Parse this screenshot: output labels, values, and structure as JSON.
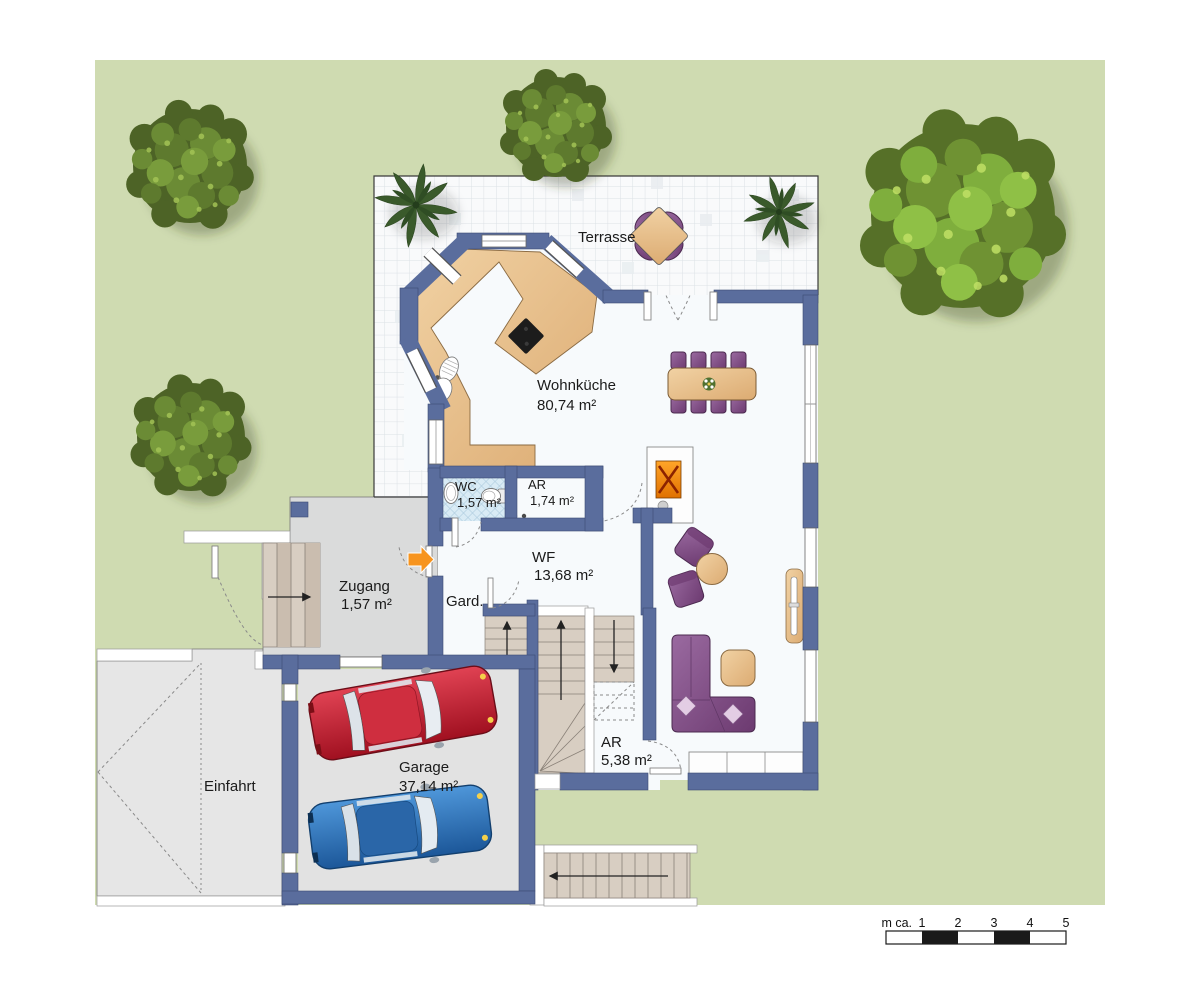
{
  "rooms": {
    "terrasse": {
      "label": "Terrasse"
    },
    "wohnkueche": {
      "label": "Wohnküche",
      "area": "80,74 m²"
    },
    "wc": {
      "label": "WC",
      "area": "1,57 m²"
    },
    "ar_eg": {
      "label": "AR",
      "area": "1,74 m²"
    },
    "wf": {
      "label": "WF",
      "area": "13,68 m²"
    },
    "zugang": {
      "label": "Zugang",
      "area": "1,57 m²"
    },
    "gard": {
      "label": "Gard."
    },
    "garage": {
      "label": "Garage",
      "area": "37,14 m²"
    },
    "ar_ug": {
      "label": "AR",
      "area": "5,38 m²"
    },
    "einfahrt": {
      "label": "Einfahrt"
    }
  },
  "scale_bar": {
    "unit_label": "m ca.",
    "ticks": [
      "1",
      "2",
      "3",
      "4",
      "5"
    ]
  },
  "symbols": {
    "entrance_arrow": "orange-arrow-right",
    "door_swings": "dashed-arcs",
    "stair_direction": "black-arrows"
  },
  "colors": {
    "garden": "#cfdbb1",
    "walls": "#5a6d9d",
    "wood": "#e9c495",
    "upholstery": "#7d4a82",
    "accent_orange": "#f7941e",
    "car_red": "#c2182b",
    "car_blue": "#2a6cb3",
    "paving_gray": "#e0e0e0",
    "wc_tile": "#d9ebf5"
  }
}
